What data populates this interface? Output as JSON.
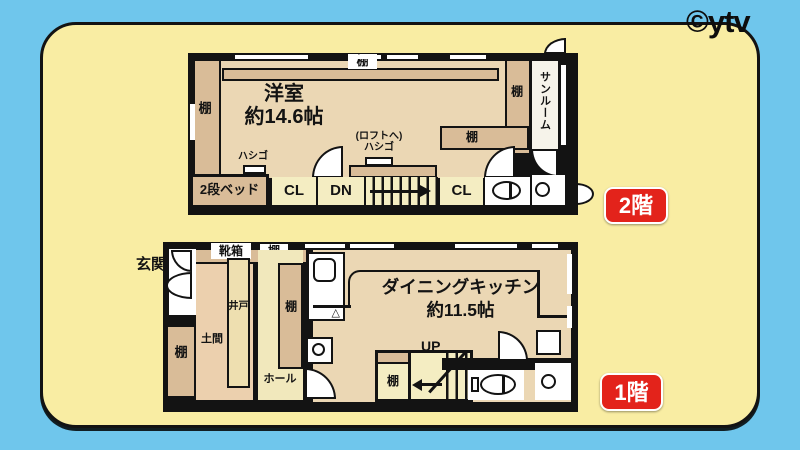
{
  "watermark": "©ytv",
  "colors": {
    "background_blue": "#6fc6ec",
    "panel_yellow": "#f9eda3",
    "badge_red": "#e3231b",
    "floor_tan": "#ebd7b4",
    "shelf_tan": "#d9bc98",
    "closet_cream": "#f4edc2",
    "wall_black": "#131313"
  },
  "floor2": {
    "badge": "2階",
    "room_name": "洋室",
    "room_size": "約14.6帖",
    "shelf_left": "棚",
    "shelf_top": "棚",
    "shelf_right": "棚",
    "shelf_inner": "棚",
    "sunroom": "サンルーム",
    "ladder": "ハシゴ",
    "loft_note_line1": "(ロフトへ)",
    "loft_note_line2": "ハシゴ",
    "bunk_bed": "2段ベッド",
    "closet1": "CL",
    "down": "DN",
    "closet2": "CL"
  },
  "floor1": {
    "badge": "1階",
    "entrance": "玄関",
    "shoe_box": "靴箱",
    "shelf_top": "棚",
    "shelf_left": "棚",
    "shelf_hall": "棚",
    "shelf_stairs": "棚",
    "well": "井戸",
    "dirt_floor": "土間",
    "hall": "ホール",
    "room_name": "ダイニングキッチン",
    "room_size": "約11.5帖",
    "up": "UP",
    "stove_symbol": "△"
  }
}
